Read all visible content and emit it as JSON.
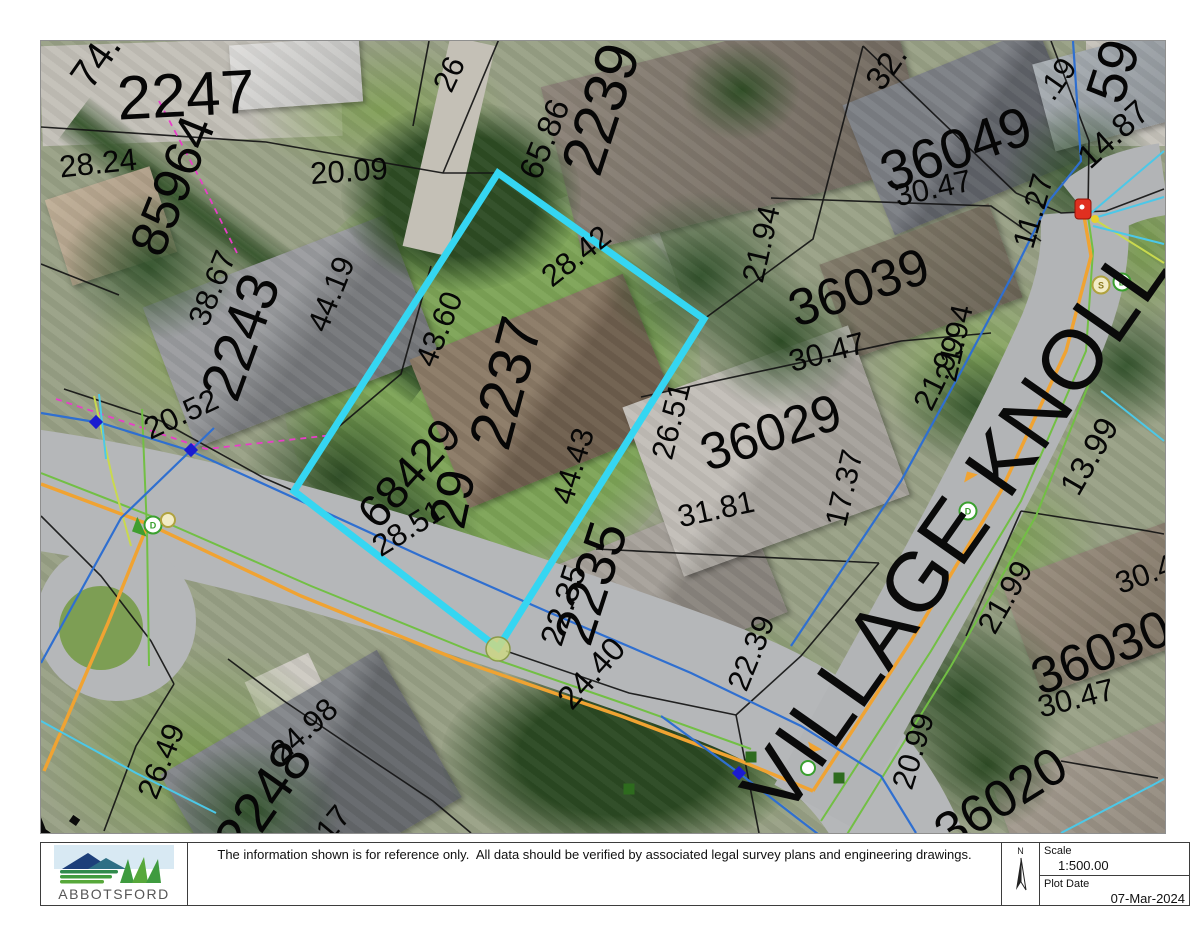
{
  "footer": {
    "logo_text": "ABBOTSFORD",
    "disclaimer": "The information shown is for reference only.  All data should be verified by associated legal survey plans and engineering drawings.",
    "north_label": "N",
    "scale_label": "Scale",
    "scale_value": "1:500.00",
    "plot_date_label": "Plot Date",
    "plot_date_value": "07-Mar-2024"
  },
  "map": {
    "street_name": "VILLAGE KNOLL",
    "edge_street_fragment": "Y.",
    "highlight_color": "#35d6f2",
    "labels": [
      {
        "kind": "parcel",
        "text": "2247",
        "x": 185,
        "y": 95,
        "rot": -3,
        "size": 62
      },
      {
        "kind": "parcel",
        "text": "2243",
        "x": 240,
        "y": 336,
        "rot": -70,
        "size": 58
      },
      {
        "kind": "parcel",
        "text": "2239",
        "x": 600,
        "y": 108,
        "rot": -72,
        "size": 60
      },
      {
        "kind": "parcel",
        "text": "2237",
        "x": 505,
        "y": 382,
        "rot": -75,
        "size": 60
      },
      {
        "kind": "parcel",
        "text": "2235",
        "x": 590,
        "y": 582,
        "rot": -72,
        "size": 56
      },
      {
        "kind": "parcel",
        "text": "2248",
        "x": 262,
        "y": 798,
        "rot": -55,
        "size": 56
      },
      {
        "kind": "parcel",
        "text": "85964",
        "x": 172,
        "y": 185,
        "rot": -68,
        "size": 52
      },
      {
        "kind": "parcel",
        "text": "68429",
        "x": 408,
        "y": 472,
        "rot": -48,
        "size": 46
      },
      {
        "kind": "parcel",
        "text": "29",
        "x": 452,
        "y": 498,
        "rot": -78,
        "size": 52
      },
      {
        "kind": "parcel",
        "text": "36049",
        "x": 955,
        "y": 148,
        "rot": -19,
        "size": 56
      },
      {
        "kind": "parcel",
        "text": "36039",
        "x": 858,
        "y": 287,
        "rot": -19,
        "size": 52
      },
      {
        "kind": "parcel",
        "text": "36029",
        "x": 770,
        "y": 432,
        "rot": -18,
        "size": 52
      },
      {
        "kind": "parcel",
        "text": "36030",
        "x": 1100,
        "y": 652,
        "rot": -22,
        "size": 52
      },
      {
        "kind": "parcel",
        "text": "36020",
        "x": 1000,
        "y": 798,
        "rot": -32,
        "size": 52
      },
      {
        "kind": "parcel",
        "text": "59",
        "x": 1112,
        "y": 70,
        "rot": -72,
        "size": 56
      },
      {
        "kind": "parcel",
        "text": "74.",
        "x": 95,
        "y": 60,
        "rot": -55,
        "size": 40
      },
      {
        "kind": "dimension",
        "text": "28.24",
        "x": 97,
        "y": 162,
        "rot": -6,
        "size": 31
      },
      {
        "kind": "dimension",
        "text": "20.09",
        "x": 348,
        "y": 170,
        "rot": -4,
        "size": 31
      },
      {
        "kind": "dimension",
        "text": "26",
        "x": 448,
        "y": 73,
        "rot": -65,
        "size": 31
      },
      {
        "kind": "dimension",
        "text": "65.86",
        "x": 543,
        "y": 138,
        "rot": -68,
        "size": 33
      },
      {
        "kind": "dimension",
        "text": "38.67",
        "x": 211,
        "y": 287,
        "rot": -68,
        "size": 31
      },
      {
        "kind": "dimension",
        "text": "44.19",
        "x": 330,
        "y": 293,
        "rot": -68,
        "size": 31
      },
      {
        "kind": "dimension",
        "text": "20.52",
        "x": 180,
        "y": 413,
        "rot": -25,
        "size": 31
      },
      {
        "kind": "dimension",
        "text": "43.60",
        "x": 438,
        "y": 328,
        "rot": -68,
        "size": 31
      },
      {
        "kind": "dimension",
        "text": "28.42",
        "x": 575,
        "y": 255,
        "rot": -38,
        "size": 31
      },
      {
        "kind": "dimension",
        "text": "44.43",
        "x": 572,
        "y": 465,
        "rot": -73,
        "size": 31
      },
      {
        "kind": "dimension",
        "text": "28.51",
        "x": 407,
        "y": 527,
        "rot": -32,
        "size": 31
      },
      {
        "kind": "dimension",
        "text": "21.94",
        "x": 760,
        "y": 243,
        "rot": -77,
        "size": 31
      },
      {
        "kind": "dimension",
        "text": "21.94",
        "x": 953,
        "y": 342,
        "rot": -77,
        "size": 31
      },
      {
        "kind": "dimension",
        "text": "30.47",
        "x": 932,
        "y": 187,
        "rot": -12,
        "size": 31
      },
      {
        "kind": "dimension",
        "text": "30.47",
        "x": 826,
        "y": 351,
        "rot": -15,
        "size": 31
      },
      {
        "kind": "dimension",
        "text": "30.47",
        "x": 1075,
        "y": 697,
        "rot": -14,
        "size": 31
      },
      {
        "kind": "dimension",
        "text": "30.47",
        "x": 1152,
        "y": 570,
        "rot": -20,
        "size": 31
      },
      {
        "kind": "dimension",
        "text": "14.87",
        "x": 1112,
        "y": 133,
        "rot": -42,
        "size": 33
      },
      {
        "kind": "dimension",
        "text": ".19",
        "x": 1056,
        "y": 78,
        "rot": -55,
        "size": 31
      },
      {
        "kind": "dimension",
        "text": "11.27",
        "x": 1032,
        "y": 210,
        "rot": -74,
        "size": 31
      },
      {
        "kind": "dimension",
        "text": "32.",
        "x": 885,
        "y": 66,
        "rot": -55,
        "size": 33
      },
      {
        "kind": "dimension",
        "text": "26.51",
        "x": 670,
        "y": 420,
        "rot": -76,
        "size": 31
      },
      {
        "kind": "dimension",
        "text": "17.37",
        "x": 843,
        "y": 487,
        "rot": -77,
        "size": 31
      },
      {
        "kind": "dimension",
        "text": "31.81",
        "x": 715,
        "y": 508,
        "rot": -12,
        "size": 31
      },
      {
        "kind": "dimension",
        "text": "21.99",
        "x": 938,
        "y": 372,
        "rot": -64,
        "size": 31
      },
      {
        "kind": "dimension",
        "text": "21.99",
        "x": 1004,
        "y": 596,
        "rot": -60,
        "size": 31
      },
      {
        "kind": "dimension",
        "text": "13.99",
        "x": 1088,
        "y": 455,
        "rot": -60,
        "size": 33
      },
      {
        "kind": "dimension",
        "text": "22.35",
        "x": 562,
        "y": 604,
        "rot": -72,
        "size": 33
      },
      {
        "kind": "dimension",
        "text": "24.40",
        "x": 590,
        "y": 672,
        "rot": -48,
        "size": 33
      },
      {
        "kind": "dimension",
        "text": "22.39",
        "x": 750,
        "y": 652,
        "rot": -68,
        "size": 31
      },
      {
        "kind": "dimension",
        "text": "20.99",
        "x": 912,
        "y": 750,
        "rot": -73,
        "size": 31
      },
      {
        "kind": "dimension",
        "text": "26.49",
        "x": 160,
        "y": 760,
        "rot": -68,
        "size": 31
      },
      {
        "kind": "dimension",
        "text": "24.98",
        "x": 303,
        "y": 729,
        "rot": -42,
        "size": 31
      },
      {
        "kind": "dimension",
        "text": "17",
        "x": 332,
        "y": 822,
        "rot": -50,
        "size": 31
      }
    ],
    "symbols": {
      "diamonds": [
        {
          "x": 95,
          "y": 421
        },
        {
          "x": 190,
          "y": 449
        },
        {
          "x": 738,
          "y": 772
        }
      ],
      "squares": [
        {
          "x": 628,
          "y": 788
        },
        {
          "x": 750,
          "y": 756
        },
        {
          "x": 838,
          "y": 777
        }
      ],
      "manholes": [
        {
          "x": 152,
          "y": 524,
          "letter": "D",
          "type": "d"
        },
        {
          "x": 167,
          "y": 519,
          "letter": "",
          "type": "s"
        },
        {
          "x": 967,
          "y": 510,
          "letter": "D",
          "type": "d"
        },
        {
          "x": 1100,
          "y": 284,
          "letter": "S",
          "type": "s"
        },
        {
          "x": 1121,
          "y": 281,
          "letter": "D",
          "type": "d"
        },
        {
          "x": 807,
          "y": 767,
          "letter": "",
          "type": "d"
        }
      ],
      "hydrant": {
        "x": 1082,
        "y": 208
      },
      "hydrant_dot": {
        "x": 1094,
        "y": 218
      },
      "orange_arrows": [
        {
          "x": 812,
          "y": 748,
          "rot": 30
        },
        {
          "x": 968,
          "y": 474,
          "rot": 150
        }
      ],
      "green_arrows": [
        {
          "x": 136,
          "y": 528,
          "rot": 65
        }
      ]
    }
  }
}
